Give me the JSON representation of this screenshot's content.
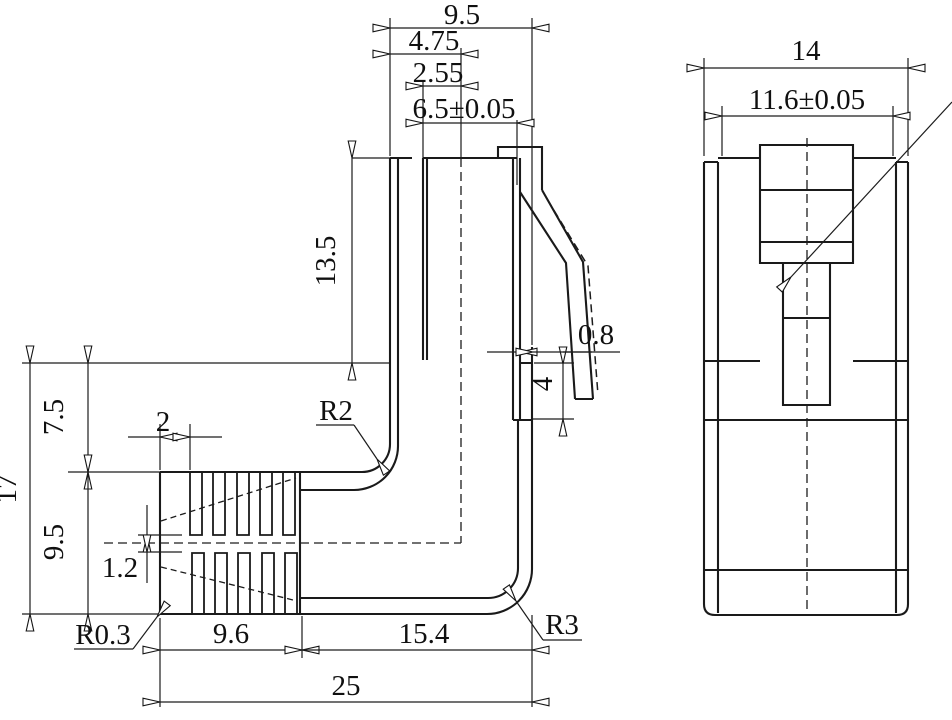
{
  "front": {
    "top_width": "9.5",
    "half_width": "4.75",
    "contact_offset": "2.55",
    "contact_window": "6.5±0.05",
    "plug_height": "13.5",
    "overall_height": "17",
    "upper_height": "7.5",
    "boot_height": "9.5",
    "rib_offset": "2",
    "band_width": "1.2",
    "latch_gap": "0.8",
    "latch_engage": "4",
    "boot_length": "9.6",
    "body_length": "15.4",
    "overall_length": "25",
    "r_inner": "R2",
    "r_outer": "R3",
    "r_corner": "R0.3"
  },
  "side": {
    "overall_width": "14",
    "window_width": "11.6±0.05"
  },
  "style": {
    "line_color": "#1a1a1a",
    "background": "#ffffff"
  }
}
